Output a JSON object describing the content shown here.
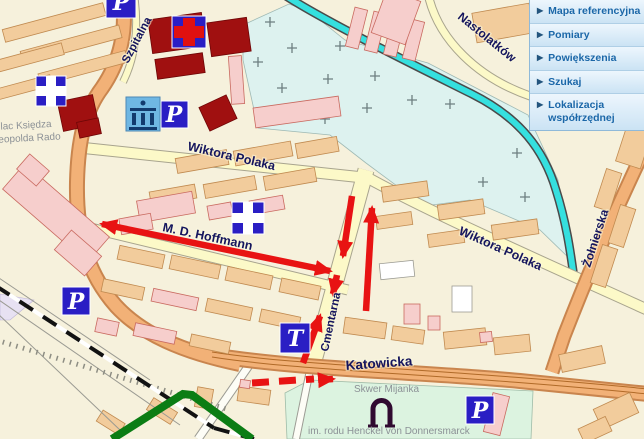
{
  "panel": {
    "items": [
      {
        "label": "Mapa referencyjna"
      },
      {
        "label": "Pomiary"
      },
      {
        "label": "Powiększenia"
      },
      {
        "label": "Szukaj"
      },
      {
        "label": "Lokalizacja współrzędnej"
      }
    ]
  },
  "map": {
    "streets": {
      "szpitalna": "Szpitalna",
      "nastolatkow": "Nastolatków",
      "wiktora_polaka_west": "Wiktora Polaka",
      "wiktora_polaka_east": "Wiktora Polaka",
      "hoffmann": "M. D. Hoffmann",
      "cmentarna": "Cmentarna",
      "katowicka": "Katowicka",
      "zolnierska": "Żołnierska"
    },
    "places": {
      "plac_line1": "Plac Księdza",
      "plac_line2": "Leopolda Rado",
      "skwer": "Skwer Mijanka",
      "skwer_dedication": "im. rodu Henckel von Donnersmarck"
    },
    "icons": {
      "parking": "P",
      "theater": "T"
    },
    "colors": {
      "road_major": "#F2B177",
      "road_minor": "#FCF9C8",
      "building_tan": "#F2CC9C",
      "building_pink": "#F6CECC",
      "building_civic": "#A01010",
      "water": "#35E0DF",
      "area_cemetery": "#DDF2EF",
      "area_park": "#DCF3E0",
      "route_red": "#E81313",
      "route_green": "#0B7D14",
      "icon_blue": "#2A1EC4"
    }
  }
}
